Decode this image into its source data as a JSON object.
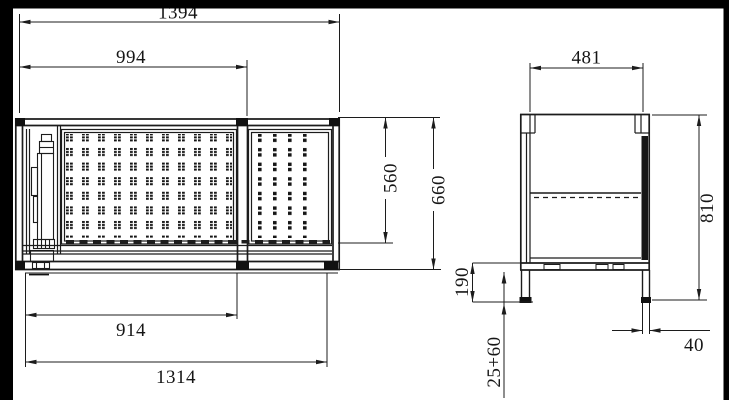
{
  "drawing": {
    "type": "technical-dimension-drawing",
    "views": {
      "front": "front-view",
      "side": "side-view"
    },
    "colors": {
      "background": "#ffffff",
      "line": "#1c1c1c",
      "fill_black": "#111111",
      "border": "#000000"
    }
  },
  "dimensions": {
    "overall_width": {
      "value": "1394"
    },
    "opening_width": {
      "value": "994"
    },
    "panel_width": {
      "value": "914"
    },
    "base_width": {
      "value": "1314"
    },
    "opening_height": {
      "value": "560"
    },
    "body_height": {
      "value": "660"
    },
    "side_width": {
      "value": "481"
    },
    "overall_height": {
      "value": "810"
    },
    "base_height": {
      "value": "190"
    },
    "foot_adjust": {
      "value": "25+60"
    },
    "leg_width": {
      "value": "40"
    }
  }
}
